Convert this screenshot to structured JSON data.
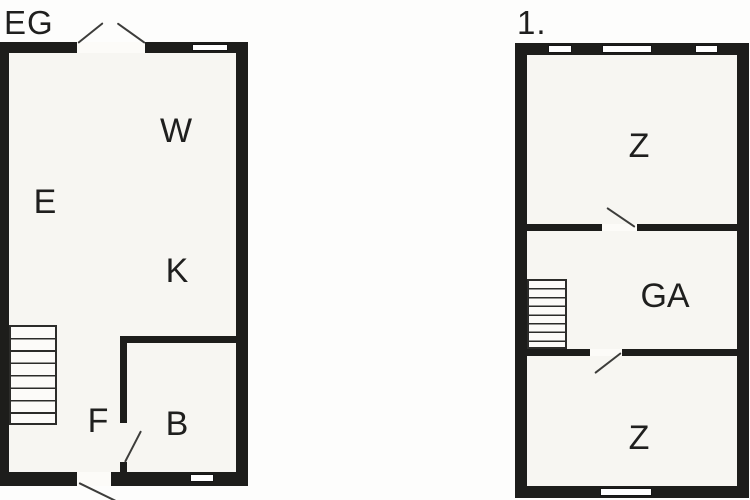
{
  "colors": {
    "wall": "#1d1d1b",
    "floor": "#f7f6f2",
    "background": "#fdfdfc",
    "door_line": "#3d3d3b",
    "label": "#1f1f1e"
  },
  "floors": {
    "eg": {
      "label": "EG",
      "rooms": {
        "w": "W",
        "e": "E",
        "k": "K",
        "f": "F",
        "b": "B"
      }
    },
    "first": {
      "label": "1.",
      "rooms": {
        "z_top": "Z",
        "ga": "GA",
        "z_bottom": "Z"
      }
    }
  }
}
